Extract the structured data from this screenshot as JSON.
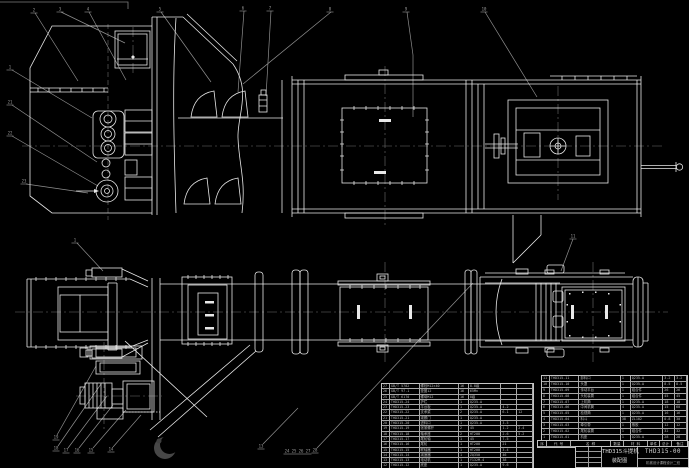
{
  "title_block": {
    "title": "THD315斗提机",
    "subtitle": "装配图",
    "drawing_no": "THD315-00",
    "note": "机械设计课程设计二班"
  },
  "bom_header": [
    "序",
    "代  号",
    "名  称",
    "数量",
    "材 料",
    "单件",
    "总计",
    "备注"
  ],
  "bom_left": {
    "rows": [
      [
        "27",
        "GB/T 5782",
        "螺栓M12×40",
        "16",
        "8.8级",
        "",
        ""
      ],
      [
        "26",
        "GB/T 97.1",
        "垫圈12",
        "16",
        "65Mn",
        "",
        ""
      ],
      [
        "25",
        "GB/T 6170",
        "螺母M12",
        "16",
        "8级",
        "",
        ""
      ],
      [
        "24",
        "THD315-24",
        "护栏",
        "1",
        "Q235-A",
        "",
        ""
      ],
      [
        "23",
        "THD315-23",
        "平台板",
        "1",
        "Q235-A",
        "4.2",
        ""
      ],
      [
        "22",
        "THD315-22",
        "支承梁",
        "2",
        "Q235-A",
        "6.1",
        "12"
      ],
      [
        "21",
        "THD315-21",
        "观察门",
        "1",
        "Q235-A",
        "",
        ""
      ],
      [
        "20",
        "THD315-20",
        "进料口",
        "1",
        "Q235-A",
        "3.5",
        ""
      ],
      [
        "19",
        "THD315-19",
        "张紧螺杆",
        "2",
        "45",
        "1.2",
        "2.4"
      ],
      [
        "18",
        "THD315-18",
        "轴承座",
        "2",
        "HT200",
        "2.6",
        "5.2"
      ],
      [
        "17",
        "THD315-17",
        "尾轮轴",
        "1",
        "45",
        "7.5",
        ""
      ],
      [
        "16",
        "THD315-16",
        "尾轮",
        "1",
        "HT200",
        "21",
        ""
      ],
      [
        "15",
        "THD315-15",
        "联轴器",
        "1",
        "HT200",
        "3.4",
        ""
      ],
      [
        "14",
        "THD315-14",
        "减速器",
        "1",
        "ZQ350",
        "46",
        ""
      ],
      [
        "13",
        "THD315-13",
        "电动机",
        "1",
        "Y132M-4",
        "38",
        ""
      ],
      [
        "12",
        "THD315-12",
        "底座",
        "1",
        "Q235-A",
        "9.6",
        ""
      ]
    ]
  },
  "bom_right": {
    "rows": [
      [
        "11",
        "THD315-11",
        "卸料口",
        "1",
        "Q235-A",
        "3.2",
        "3.2"
      ],
      [
        "10",
        "THD315-10",
        "头罩",
        "1",
        "Q235-A",
        "8.5",
        "8.5"
      ],
      [
        "9",
        "THD315-09",
        "传动平台",
        "1",
        "组合件",
        "26",
        "26"
      ],
      [
        "8",
        "THD315-08",
        "头轮装置",
        "1",
        "组合件",
        "45",
        "45"
      ],
      [
        "7",
        "THD315-07",
        "上机筒",
        "1",
        "Q235-A",
        "18",
        "18"
      ],
      [
        "6",
        "THD315-06",
        "中间机筒",
        "4",
        "Q235-A",
        "15",
        "60"
      ],
      [
        "5",
        "THD315-05",
        "检视筒",
        "1",
        "Q235-A",
        "16",
        "16"
      ],
      [
        "4",
        "THD315-04",
        "料斗",
        "38",
        "ZL102",
        "0.8",
        "30"
      ],
      [
        "3",
        "THD315-03",
        "牵引带",
        "1",
        "橡胶",
        "12",
        "12"
      ],
      [
        "2",
        "THD315-02",
        "尾轮装置",
        "1",
        "组合件",
        "32",
        "32"
      ],
      [
        "1",
        "THD315-01",
        "机座",
        "1",
        "Q235-A",
        "28",
        "28"
      ]
    ]
  },
  "callouts": [
    {
      "x": 34,
      "y": 10,
      "label": "2"
    },
    {
      "x": 60,
      "y": 9,
      "label": "3"
    },
    {
      "x": 88,
      "y": 9,
      "label": "4"
    },
    {
      "x": 160,
      "y": 9,
      "label": "5"
    },
    {
      "x": 243,
      "y": 8,
      "label": "6"
    },
    {
      "x": 270,
      "y": 8,
      "label": "7"
    },
    {
      "x": 330,
      "y": 9,
      "label": "8"
    },
    {
      "x": 406,
      "y": 9,
      "label": "9"
    },
    {
      "x": 484,
      "y": 9,
      "label": "10"
    },
    {
      "x": 10,
      "y": 67,
      "label": "1"
    },
    {
      "x": 10,
      "y": 102,
      "label": "21"
    },
    {
      "x": 10,
      "y": 133,
      "label": "22"
    },
    {
      "x": 24,
      "y": 181,
      "label": "23"
    },
    {
      "x": 75,
      "y": 240,
      "label": "1"
    },
    {
      "x": 573,
      "y": 236,
      "label": "11"
    },
    {
      "x": 56,
      "y": 437,
      "label": "19"
    },
    {
      "x": 56,
      "y": 448,
      "label": "18"
    },
    {
      "x": 66,
      "y": 450,
      "label": "17"
    },
    {
      "x": 77,
      "y": 450,
      "label": "16"
    },
    {
      "x": 91,
      "y": 450,
      "label": "15"
    },
    {
      "x": 111,
      "y": 449,
      "label": "14"
    },
    {
      "x": 261,
      "y": 446,
      "label": "13"
    },
    {
      "x": 287,
      "y": 451,
      "label": "24"
    },
    {
      "x": 294,
      "y": 451,
      "label": "25"
    },
    {
      "x": 301,
      "y": 451,
      "label": "26"
    },
    {
      "x": 308,
      "y": 451,
      "label": "27"
    },
    {
      "x": 315,
      "y": 450,
      "label": "28"
    }
  ]
}
